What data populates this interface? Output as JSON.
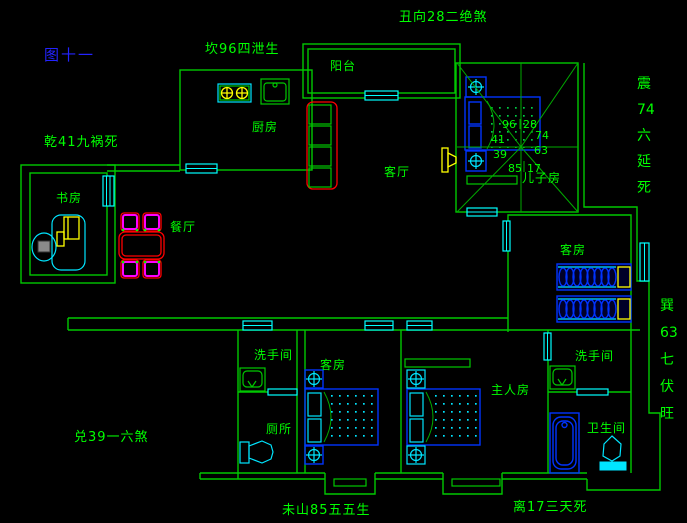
{
  "title": "图十一",
  "fengshui_labels": {
    "top": "坎96四泄生",
    "top_right": "丑向28二绝煞",
    "left_top": "乾41九祸死",
    "left_bottom": "兑39一六煞",
    "bottom_left": "未山85五五生",
    "bottom_right": "离17三天死",
    "right_top_vertical": [
      "震",
      "74",
      "六",
      "延",
      "死"
    ],
    "right_bottom_vertical": [
      "巽",
      "63",
      "七",
      "伏",
      "旺"
    ]
  },
  "rooms": {
    "balcony": "阳台",
    "kitchen": "厨房",
    "living_room": "客厅",
    "dining_room": "餐厅",
    "study": "书房",
    "son_room": "儿子房",
    "guest_room_east": "客房",
    "guest_room_south": "客房",
    "master_bedroom": "主人房",
    "washroom_west": "洗手间",
    "washroom_east": "洗手间",
    "toilet": "厕所",
    "bathroom": "卫生间"
  },
  "compass_numbers": {
    "top_left": "96",
    "top_right": "28",
    "left_upper": "41",
    "right_upper": "74",
    "left_lower": "39",
    "right_lower": "63",
    "bottom_left": "85",
    "bottom_right": "17"
  },
  "colors": {
    "background": "#000000",
    "wall_green": "#00c800",
    "text_green": "#00ff00",
    "title_blue": "#2323ff",
    "window_cyan": "#00ffff",
    "furniture_blue": "#0033ff",
    "door_yellow": "#ffff00",
    "sofa_red": "#ff0000",
    "chair_magenta": "#ff00ff"
  }
}
